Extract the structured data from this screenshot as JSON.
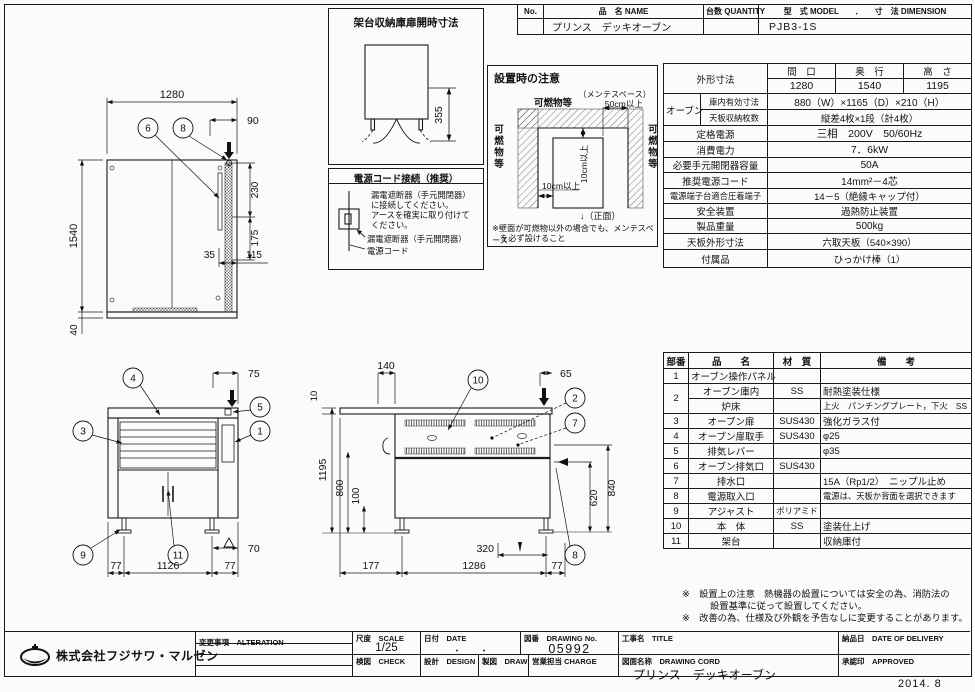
{
  "doc": {
    "year": "2014. 8"
  },
  "header_table": {
    "col_no": "No.",
    "col_name": "品　名 NAME",
    "col_qty": "台数 QUANTITY",
    "col_model": "型　式 MODEL　　．　　寸　法 DIMENSION",
    "val_name": "プリンス　デッキオーブン",
    "val_model": "PJB3-1S"
  },
  "door_box": {
    "title": "架台収納庫扉開時寸法",
    "dim355": "355"
  },
  "power_box": {
    "title": "電源コード接続（推奨）",
    "text1": "漏電遮断器（手元開閉器）",
    "text2": "に接続してください。",
    "text3": "アースを確実に取り付けて",
    "text4": "ください。",
    "label_breaker": "漏電遮断器（手元開閉器）",
    "label_cord": "電源コード"
  },
  "install_box": {
    "title": "設置時の注意",
    "maint1": "（メンテスペース）",
    "maint2": "50cm以上",
    "flam_top": "可燃物等",
    "flam_left": "可燃物等",
    "flam_right": "可燃物等",
    "clear_v": "10cm以上",
    "clear_h": "10cm以上",
    "front_mark": "↓（正面）",
    "note1": "※壁面が可燃物以外の場合でも、メンテスペース",
    "note2": "を必ず設けること"
  },
  "spec_table": {
    "outer": "外形寸法",
    "w_h": "間　口",
    "d_h": "奥　行",
    "h_h": "高　さ",
    "w": "1280",
    "d": "1540",
    "h": "1195",
    "oven": "オーブン",
    "inner_l": "庫内有効寸法",
    "inner_v": "880（W）×1165（D）×210（H）",
    "tray_l": "天板収納枚数",
    "tray_v": "縦差4枚×1段（計4枚）",
    "rated_l": "定格電源",
    "rated_v": "三相　200V　50/60Hz",
    "cons_l": "消費電力",
    "cons_v": "7．6kW",
    "brk_l": "必要手元開閉器容量",
    "brk_v": "50A",
    "cord_l": "推奨電源コード",
    "cord_v": "14mm²－4芯",
    "term_l": "電源端子台適合圧着端子",
    "term_v": "14－5（絶縁キャップ付）",
    "safe_l": "安全装置",
    "safe_v": "過熱防止装置",
    "wt_l": "製品重量",
    "wt_v": "500kg",
    "plate_l": "天板外形寸法",
    "plate_v": "六取天板（540×390）",
    "acc_l": "付属品",
    "acc_v": "ひっかけ棒（1）"
  },
  "parts_table": {
    "h_no": "部番",
    "h_name": "品　　名",
    "h_mat": "材　質",
    "h_note": "備　　考",
    "rows": [
      {
        "no": "1",
        "name": "オーブン操作パネル",
        "mat": "",
        "note": ""
      },
      {
        "no": "2",
        "name": "オーブン庫内",
        "mat": "SS",
        "note": "耐熱塗装仕様"
      },
      {
        "no": "",
        "name": "炉床",
        "mat": "",
        "note": "上火　パンチングプレート，下火　SS"
      },
      {
        "no": "3",
        "name": "オーブン扉",
        "mat": "SUS430",
        "note": "強化ガラス付"
      },
      {
        "no": "4",
        "name": "オーブン扉取手",
        "mat": "SUS430",
        "note": "φ25"
      },
      {
        "no": "5",
        "name": "排気レバー",
        "mat": "",
        "note": "φ35"
      },
      {
        "no": "6",
        "name": "オーブン排気口",
        "mat": "SUS430",
        "note": ""
      },
      {
        "no": "7",
        "name": "排水口",
        "mat": "",
        "note": "15A（Rp1/2）　ニップル止め"
      },
      {
        "no": "8",
        "name": "電源取入口",
        "mat": "",
        "note": "電源は、天板か背面を選択できます"
      },
      {
        "no": "9",
        "name": "アジャスト",
        "mat": "ポリアミド",
        "note": ""
      },
      {
        "no": "10",
        "name": "本　体",
        "mat": "SS",
        "note": "塗装仕上げ"
      },
      {
        "no": "11",
        "name": "架台",
        "mat": "",
        "note": "収納庫付"
      }
    ]
  },
  "remarks": {
    "line1": "※　設置上の注意　熱機器の設置については安全の為、消防法の",
    "line2": "設置基準に従って設置してください。",
    "line3": "※　改善の為、仕様及び外観を予告なしに変更することがあります。"
  },
  "plan_view": {
    "d_width": "1280",
    "d_height": "1540",
    "d_base": "40",
    "d_offset": "90",
    "d_vent1": "230",
    "d_vent2": "175",
    "d_35": "35",
    "d_115": "115",
    "c6": "6",
    "c8": "8"
  },
  "front_view": {
    "d_75": "75",
    "d_70": "70",
    "d_l77": "77",
    "d_1126": "1126",
    "d_r77": "77",
    "c4": "4",
    "c5": "5",
    "c3": "3",
    "c1": "1",
    "c9": "9",
    "c11": "11"
  },
  "side_view": {
    "d_140": "140",
    "d_65": "65",
    "d_10": "10",
    "d_1195": "1195",
    "d_800": "800",
    "d_100": "100",
    "d_840": "840",
    "d_620": "620",
    "d_320": "320",
    "d_177": "177",
    "d_1286": "1286",
    "d_77": "77",
    "c10": "10",
    "c2": "2",
    "c7": "7",
    "c8": "8"
  },
  "title_block": {
    "company": "株式会社フジサワ・マルゼン",
    "alteration": "変更事項　ALTERATION",
    "scale_l": "尺度　SCALE",
    "scale_v": "1/25",
    "date_l": "日付　DATE",
    "date_v": "・　　・",
    "no_l": "図番　DRAWING No.",
    "no_v": "05992",
    "title_l": "工事名　TITLE",
    "delivery_l": "納品日　DATE OF DELIVERY",
    "check_l": "検図　CHECK",
    "design_l": "設計　DESIGN",
    "draw_l": "製図　DRAW",
    "charge_l": "営業担当 CHARGE",
    "dname_l": "図面名称　DRAWING CORD",
    "dname_v": "プリンス　デッキオーブン",
    "approved_l": "承認印　APPROVED"
  }
}
